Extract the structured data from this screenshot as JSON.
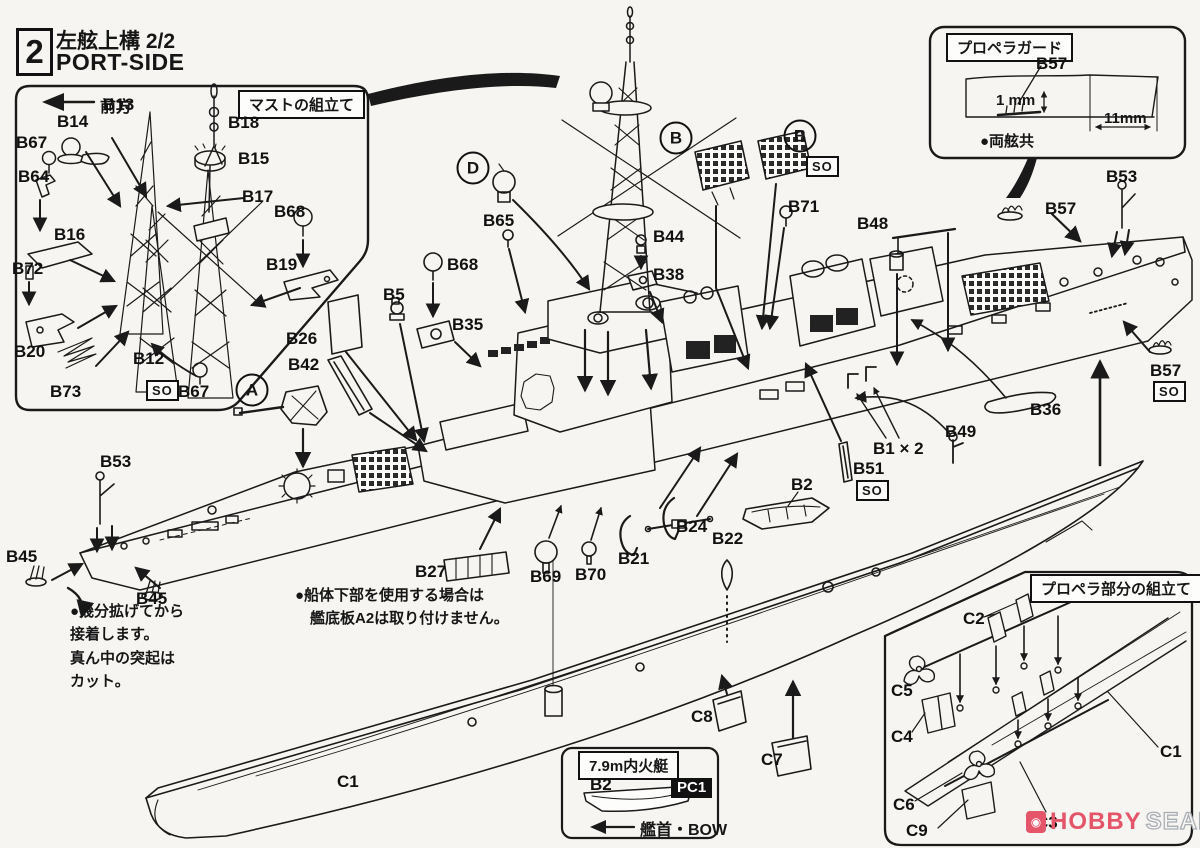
{
  "header": {
    "step": "2",
    "title": "左舷上構  2/2",
    "subtitle": "PORT-SIDE"
  },
  "insets": {
    "mast": {
      "title": "マストの組立て",
      "direction": "前方"
    },
    "prop_guard": {
      "title": "プロペラガード",
      "dim_small": "1 mm",
      "dim_wide": "11mm",
      "note": "●両舷共"
    },
    "boat": {
      "title": "7.9m内火艇",
      "paint_code": "PC1",
      "bow": "艦首・BOW"
    },
    "propeller": {
      "title": "プロペラ部分の組立て"
    }
  },
  "notes": {
    "bow": [
      "●幾分拡げてから",
      "接着します。",
      "真ん中の突起は",
      "カット。"
    ],
    "hull": [
      "●船体下部を使用する場合は",
      "　艦底板A2は取り付けません。"
    ]
  },
  "so_label": "SO",
  "watermark": {
    "brand": "HOBBY",
    "suffix": "SEARCH"
  },
  "colors": {
    "ink": "#1a1a1a",
    "paper": "#f6f5f1",
    "pink": "#e4556a",
    "gray": "#a9aeb5"
  },
  "part_labels": [
    {
      "t": "B13",
      "x": 103,
      "y": 96
    },
    {
      "t": "B14",
      "x": 57,
      "y": 113
    },
    {
      "t": "B67",
      "x": 16,
      "y": 134
    },
    {
      "t": "B64",
      "x": 18,
      "y": 168
    },
    {
      "t": "B16",
      "x": 54,
      "y": 226
    },
    {
      "t": "B18",
      "x": 228,
      "y": 114
    },
    {
      "t": "B15",
      "x": 238,
      "y": 150
    },
    {
      "t": "B17",
      "x": 242,
      "y": 188
    },
    {
      "t": "B68",
      "x": 274,
      "y": 203
    },
    {
      "t": "B19",
      "x": 266,
      "y": 256
    },
    {
      "t": "B72",
      "x": 12,
      "y": 260
    },
    {
      "t": "B20",
      "x": 14,
      "y": 343
    },
    {
      "t": "B73",
      "x": 50,
      "y": 383
    },
    {
      "t": "B12",
      "x": 133,
      "y": 350
    },
    {
      "t": "B67",
      "x": 178,
      "y": 383
    },
    {
      "t": "B26",
      "x": 286,
      "y": 330
    },
    {
      "t": "B42",
      "x": 288,
      "y": 356
    },
    {
      "t": "B53",
      "x": 100,
      "y": 453
    },
    {
      "t": "B45",
      "x": 6,
      "y": 548
    },
    {
      "t": "B45",
      "x": 136,
      "y": 590
    },
    {
      "t": "B5",
      "x": 383,
      "y": 286
    },
    {
      "t": "B68",
      "x": 447,
      "y": 256
    },
    {
      "t": "B35",
      "x": 452,
      "y": 316
    },
    {
      "t": "B65",
      "x": 483,
      "y": 212
    },
    {
      "t": "B44",
      "x": 653,
      "y": 228
    },
    {
      "t": "B38",
      "x": 653,
      "y": 266
    },
    {
      "t": "B71",
      "x": 788,
      "y": 198
    },
    {
      "t": "B48",
      "x": 857,
      "y": 215
    },
    {
      "t": "B57",
      "x": 1036,
      "y": 55
    },
    {
      "t": "B57",
      "x": 1045,
      "y": 200
    },
    {
      "t": "B53",
      "x": 1106,
      "y": 168
    },
    {
      "t": "B57",
      "x": 1150,
      "y": 362
    },
    {
      "t": "B36",
      "x": 1030,
      "y": 401
    },
    {
      "t": "B49",
      "x": 945,
      "y": 423
    },
    {
      "t": "B1 × 2",
      "x": 873,
      "y": 440
    },
    {
      "t": "B51",
      "x": 853,
      "y": 460
    },
    {
      "t": "B2",
      "x": 791,
      "y": 476
    },
    {
      "t": "B24",
      "x": 676,
      "y": 518
    },
    {
      "t": "B22",
      "x": 712,
      "y": 530
    },
    {
      "t": "B21",
      "x": 618,
      "y": 550
    },
    {
      "t": "B27",
      "x": 415,
      "y": 563
    },
    {
      "t": "B69",
      "x": 530,
      "y": 568
    },
    {
      "t": "B70",
      "x": 575,
      "y": 566
    },
    {
      "t": "C1",
      "x": 337,
      "y": 773
    },
    {
      "t": "C8",
      "x": 691,
      "y": 708
    },
    {
      "t": "C7",
      "x": 761,
      "y": 751
    },
    {
      "t": "C2",
      "x": 963,
      "y": 610
    },
    {
      "t": "C5",
      "x": 891,
      "y": 682
    },
    {
      "t": "C4",
      "x": 891,
      "y": 728
    },
    {
      "t": "C6",
      "x": 893,
      "y": 796
    },
    {
      "t": "C9",
      "x": 906,
      "y": 822
    },
    {
      "t": "C3",
      "x": 1036,
      "y": 814
    },
    {
      "t": "C1",
      "x": 1160,
      "y": 743
    },
    {
      "t": "B2",
      "x": 590,
      "y": 776
    }
  ],
  "circled_letters": [
    {
      "t": "A",
      "x": 252,
      "y": 390
    },
    {
      "t": "D",
      "x": 473,
      "y": 168
    },
    {
      "t": "B",
      "x": 676,
      "y": 138
    },
    {
      "t": "B",
      "x": 800,
      "y": 136
    }
  ],
  "so_tags": [
    {
      "x": 146,
      "y": 380
    },
    {
      "x": 806,
      "y": 156
    },
    {
      "x": 856,
      "y": 480
    },
    {
      "x": 1153,
      "y": 381
    }
  ]
}
